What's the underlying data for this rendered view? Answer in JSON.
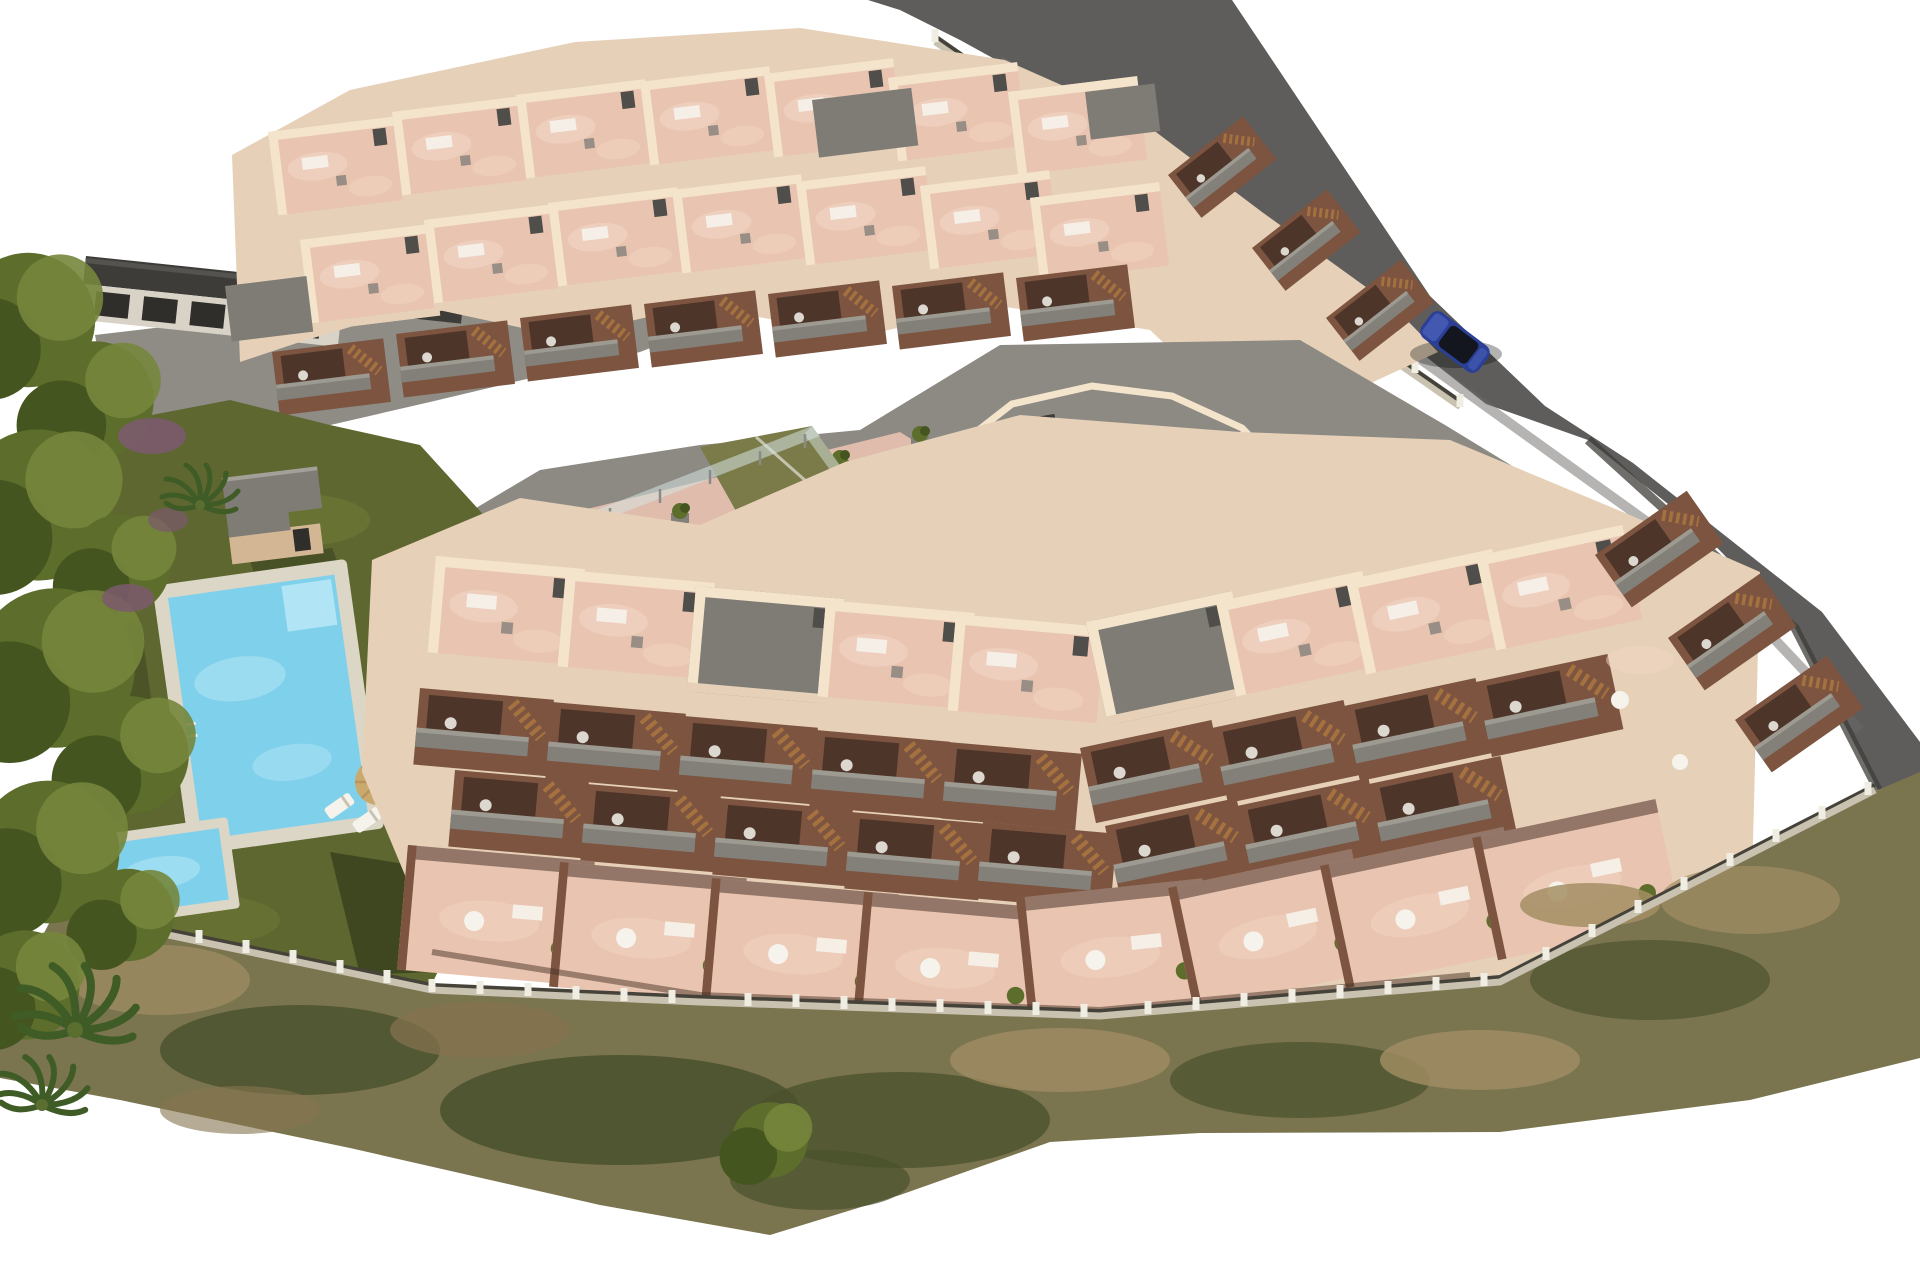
{
  "scene": {
    "title": "Aerial 3D architectural rendering of a terraced apartment complex",
    "description": "Bird's-eye render of a new-build residential development on a hillside plot: two large stepped apartment blocks with salmon-pink rooftop terraces, grey balconies and wooden stairs, a communal garden with a main pool and a children's pool, a central playground with sand pit, a padel court with glass fencing, perimeter fencing, scrubland along the lower boundary, mature trees on the left and an access road with one parked blue car at the upper right.",
    "elements": [
      "left-tree-line",
      "neighbor-building",
      "access-road",
      "roadside-fence",
      "blue-car",
      "rear-apartment-block",
      "front-apartment-block",
      "right-apartment-wing",
      "central-plaza",
      "playground",
      "padel-court",
      "communal-lawn",
      "pool-house",
      "main-pool",
      "kids-pool",
      "sun-loungers",
      "parasols",
      "perimeter-fence",
      "scrubland"
    ],
    "counts": {
      "apartment_blocks": 2,
      "swimming_pools": 2,
      "playgrounds": 1,
      "sports_courts": 1,
      "parked_cars": 1,
      "pool_parasols": 2
    }
  },
  "palette": {
    "sky": "#ffffff",
    "road": "#5e5d5b",
    "paving": "#8f8c86",
    "plaza": "#8d8a84",
    "wall_lit": "#f3e4cb",
    "wall_base": "#e6d1b8",
    "wall_shade": "#d3b795",
    "terrace_pink": "#e9c5b1",
    "terrace_pink_light": "#f2d6c4",
    "walkway_pink": "#dfbcab",
    "facade_shadow": "#7c5440",
    "recess_dark": "#4d352a",
    "balcony_gray": "#83807a",
    "balcony_rail": "#9d9a92",
    "roof_gray": "#7f7c75",
    "chimney": "#504e4a",
    "wood": "#a4713f",
    "lawn": "#5e672f",
    "lawn_light": "#75803a",
    "lawn_shadow": "#3a421f",
    "tree_dark": "#45551f",
    "tree_mid": "#5d6e2c",
    "tree_light": "#76863c",
    "shrub_purple": "#7b5a6d",
    "pool_water": "#7fd0ea",
    "pool_light": "#b7e7f6",
    "pool_deck": "#dcd6c7",
    "sand": "#dcb766",
    "sand_light": "#e8c97f",
    "court_green": "#7a7b49",
    "glass": "#d6e4e1",
    "fence_wall": "#c9c2b1",
    "fence_post": "#f0ede3",
    "fence_mesh": "#45423a",
    "scrub_base": "#7a744f",
    "scrub_dark": "#49512c",
    "scrub_tan": "#a38e64",
    "scrub_brown": "#86744f",
    "car_blue": "#2b3f96",
    "car_glass": "#14161f",
    "car_highlight": "#4a5fb8",
    "neighbor_roof": "#3d3c39",
    "neighbor_wall": "#d8d3c6",
    "window_dark": "#2f2e2b"
  }
}
